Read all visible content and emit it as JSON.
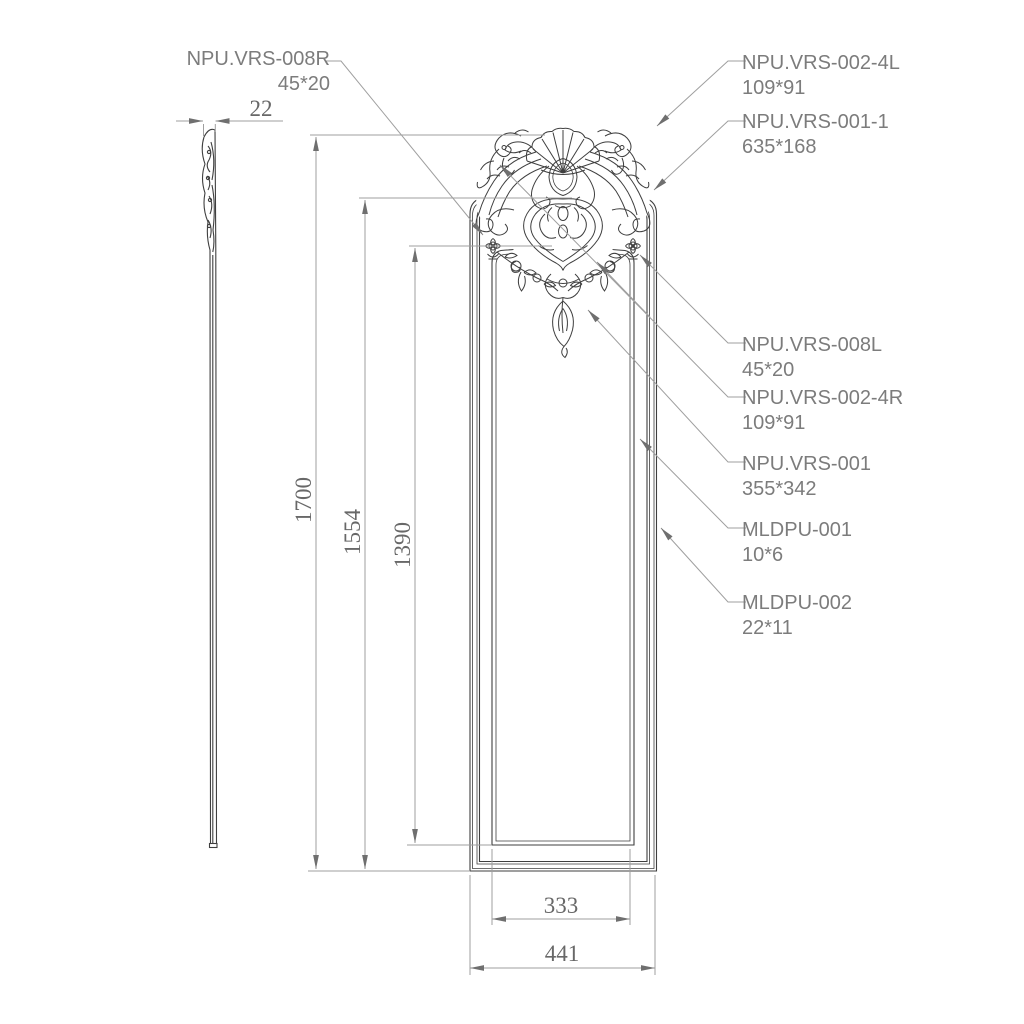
{
  "drawing": {
    "type": "technical-drawing",
    "background": "#ffffff",
    "linework_color": "#3f3f3f",
    "annotation_line_color": "#9f9f9f",
    "arrow_color": "#6f6f6f",
    "dimension_text_color": "#686868",
    "label_text_color": "#7c7c7c"
  },
  "dimensions": {
    "thickness": "22",
    "overall_height": "1700",
    "frame_height": "1554",
    "panel_opening_height": "1390",
    "panel_opening_width": "333",
    "overall_width": "441"
  },
  "part_labels": {
    "left": {
      "name": "NPU.VRS-008R",
      "size": "45*20"
    },
    "right": [
      {
        "name": "NPU.VRS-002-4L",
        "size": "109*91"
      },
      {
        "name": "NPU.VRS-001-1",
        "size": "635*168"
      },
      {
        "name": "NPU.VRS-008L",
        "size": "45*20"
      },
      {
        "name": "NPU.VRS-002-4R",
        "size": "109*91"
      },
      {
        "name": "NPU.VRS-001",
        "size": "355*342"
      },
      {
        "name": "MLDPU-001",
        "size": "10*6"
      },
      {
        "name": "MLDPU-002",
        "size": "22*11"
      }
    ]
  }
}
